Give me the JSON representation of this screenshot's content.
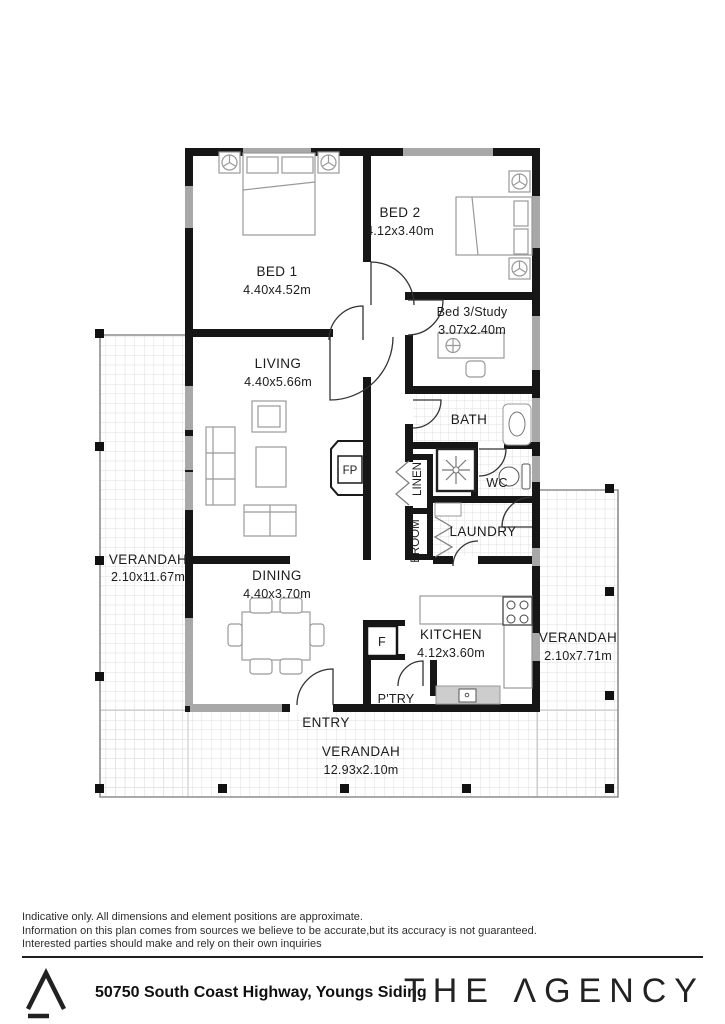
{
  "plan": {
    "rooms": {
      "bed1": {
        "name": "BED 1",
        "dims": "4.40x4.52m"
      },
      "bed2": {
        "name": "BED 2",
        "dims": "4.12x3.40m"
      },
      "bed3": {
        "name": "Bed 3/Study",
        "dims": "3.07x2.40m"
      },
      "living": {
        "name": "LIVING",
        "dims": "4.40x5.66m"
      },
      "dining": {
        "name": "DINING",
        "dims": "4.40x3.70m"
      },
      "kitchen": {
        "name": "KITCHEN",
        "dims": "4.12x3.60m"
      }
    },
    "verandah": {
      "left": {
        "name": "VERANDAH",
        "dims": "2.10x11.67m"
      },
      "right": {
        "name": "VERANDAH",
        "dims": "2.10x7.71m"
      },
      "bottom": {
        "name": "VERANDAH",
        "dims": "12.93x2.10m"
      }
    },
    "labels": {
      "bath": "BATH",
      "wc": "WC",
      "laundry": "LAUNDRY",
      "linen": "LINEN",
      "broom": "BROOM",
      "pantry": "P'TRY",
      "entry": "ENTRY",
      "fireplace": "FP",
      "fridge": "F"
    }
  },
  "disclaimer": {
    "line1": "Indicative only. All dimensions and element positions are approximate.",
    "line2": "Information on this plan comes from sources we believe to be accurate,but its accuracy is not guaranteed.",
    "line3": "Interested parties should make and rely on their own inquiries"
  },
  "footer": {
    "address": "50750 South Coast Highway, Youngs Siding",
    "brand": "THE AGENCY",
    "brand_display": "THE ΛGENCY"
  },
  "colors": {
    "wall": "#161616",
    "window": "#a8a8a8",
    "furniture": "#999999",
    "tile_line": "#dcdcdc",
    "text": "#1c1c1c"
  }
}
